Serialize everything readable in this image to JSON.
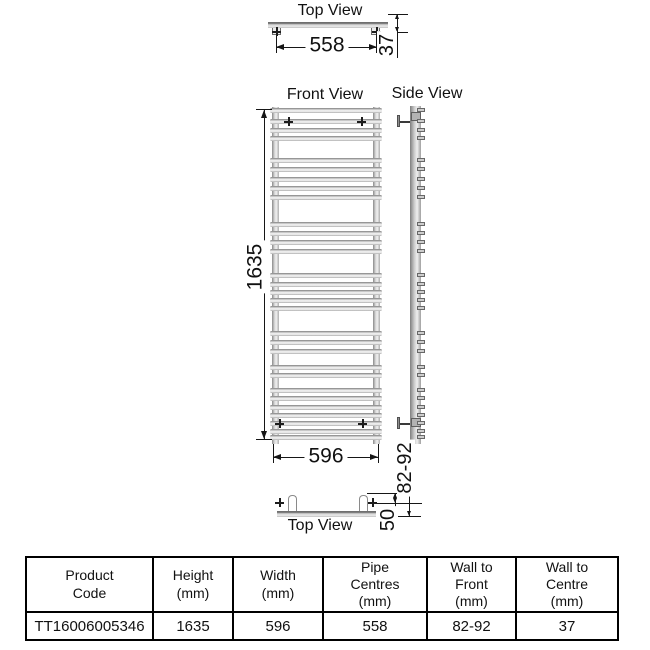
{
  "views": {
    "top_view_top": {
      "label": "Top View",
      "pipe_centres_dim": "558",
      "wall_to_centre_dim": "37"
    },
    "front_view": {
      "label": "Front View",
      "height_dim": "1635",
      "width_dim": "596"
    },
    "side_view": {
      "label": "Side View",
      "wall_to_front_dim": "82-92"
    },
    "top_view_bottom": {
      "label": "Top View",
      "bracket_offset_dim": "50"
    }
  },
  "front_bar_offsets": [
    1,
    12,
    21,
    29,
    51,
    60,
    70,
    79,
    88,
    115,
    124,
    133,
    142,
    166,
    175,
    183,
    191,
    199,
    224,
    233,
    242,
    258,
    266,
    281,
    289,
    298,
    306,
    314,
    322,
    328
  ],
  "spec_table": {
    "headers": [
      "Product\nCode",
      "Height\n(mm)",
      "Width\n(mm)",
      "Pipe\nCentres\n(mm)",
      "Wall to\nFront\n(mm)",
      "Wall to\nCentre\n(mm)"
    ],
    "rows": [
      [
        "TT16006005346",
        "1635",
        "596",
        "558",
        "82-92",
        "37"
      ]
    ]
  },
  "colors": {
    "line": "#161616",
    "metal_light": "#f4f4f4",
    "metal_dark": "#7d7d7d",
    "table_border": "#000000"
  }
}
